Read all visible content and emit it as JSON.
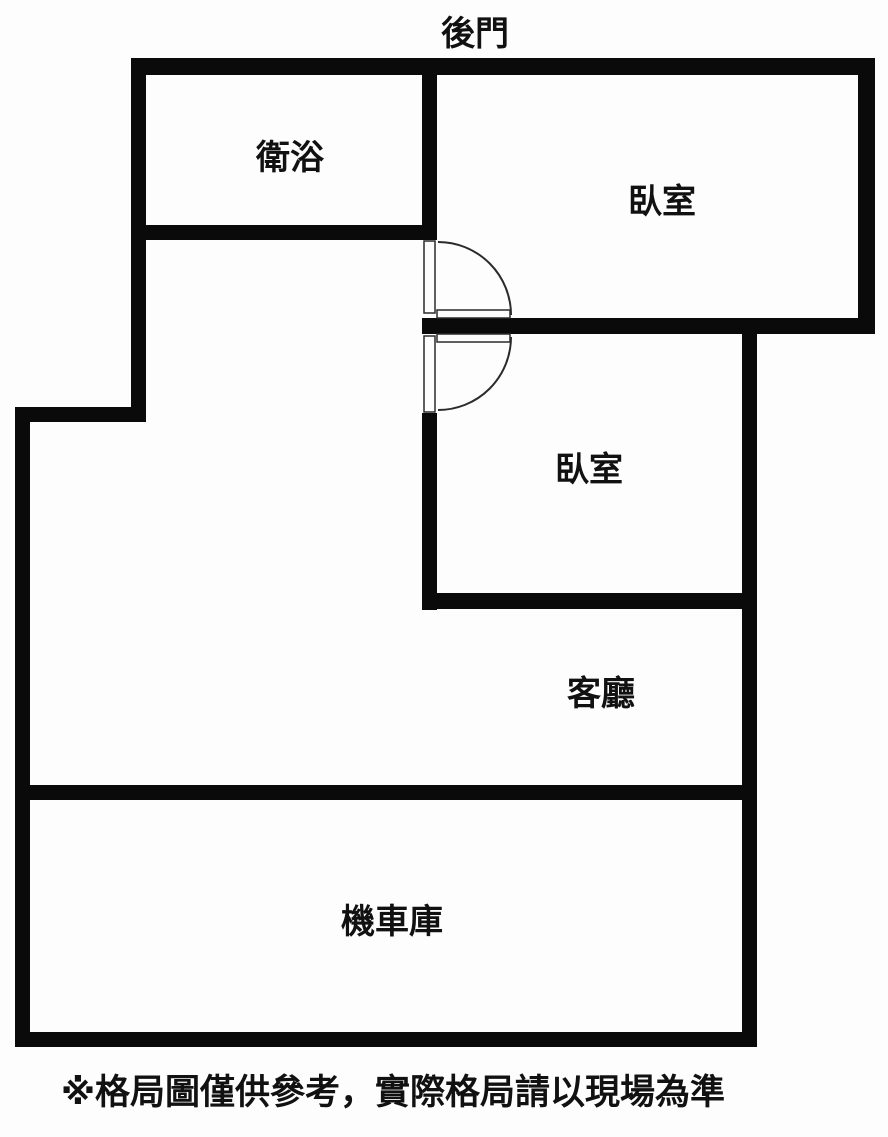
{
  "colors": {
    "wall": "#0a0a0a",
    "line": "#2b2b2b",
    "background": "#fdfdfd",
    "text": "#111111"
  },
  "floor_plan": {
    "back_door_label": "後門",
    "rooms": {
      "bathroom": "衛浴",
      "bedroom_top": "臥室",
      "bedroom_middle": "臥室",
      "living_room": "客廳",
      "garage": "機車庫"
    },
    "disclaimer": "※格局圖僅供參考，實際格局請以現場為準"
  }
}
